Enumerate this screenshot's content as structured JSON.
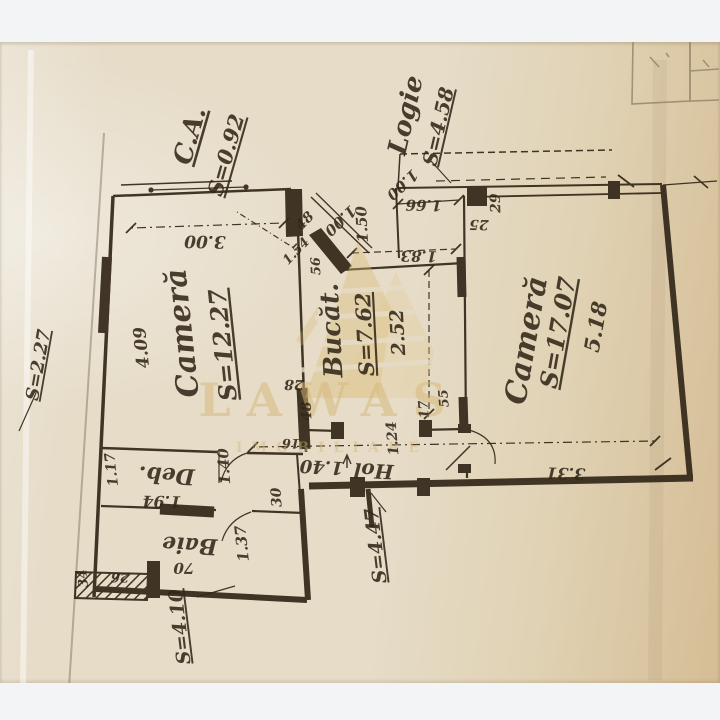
{
  "colors": {
    "ink": "#322718",
    "paper_light": "#ece5d6",
    "paper_mid": "#e6dcc8",
    "paper_dark": "#d5bd95",
    "band": "#f3f4f6",
    "gold": "#d7b878"
  },
  "watermark": {
    "name": "LAWAS",
    "tagline": "IMOBILIARE"
  },
  "labels": [
    {
      "name": "label-ca",
      "t": "C.A.",
      "x": 198,
      "y": 138,
      "r": -74,
      "s": 26,
      "u": 1
    },
    {
      "name": "label-ca-area",
      "t": "S=0.92",
      "x": 233,
      "y": 157,
      "r": -74,
      "s": 21,
      "u": 1
    },
    {
      "name": "label-logie",
      "t": "Logie",
      "x": 414,
      "y": 117,
      "r": -77,
      "s": 26,
      "u": 0
    },
    {
      "name": "label-logie-area",
      "t": "S=4.58",
      "x": 445,
      "y": 128,
      "r": -77,
      "s": 20,
      "u": 1
    },
    {
      "name": "label-camera-left",
      "t": "Cameră",
      "x": 192,
      "y": 332,
      "r": -96,
      "s": 30,
      "u": 0
    },
    {
      "name": "label-camera-left-area",
      "t": "S=12.27",
      "x": 231,
      "y": 344,
      "r": -96,
      "s": 24,
      "u": 1
    },
    {
      "name": "dim-camera-left-width",
      "t": "3.00",
      "x": 205,
      "y": 236,
      "r": 181,
      "s": 17,
      "u": 0
    },
    {
      "name": "dim-camera-left-length",
      "t": "4.09",
      "x": 147,
      "y": 347,
      "r": -96,
      "s": 17,
      "u": 0
    },
    {
      "name": "label-bucatarie",
      "t": "Bucăt.",
      "x": 340,
      "y": 330,
      "r": -93,
      "s": 26,
      "u": 0
    },
    {
      "name": "label-bucatarie-area",
      "t": "S=7.62",
      "x": 372,
      "y": 334,
      "r": -93,
      "s": 21,
      "u": 1
    },
    {
      "name": "dim-bucatarie-width",
      "t": "2.52",
      "x": 404,
      "y": 332,
      "r": -93,
      "s": 19,
      "u": 0
    },
    {
      "name": "label-camera-right",
      "t": "Cameră",
      "x": 536,
      "y": 342,
      "r": -80,
      "s": 30,
      "u": 0
    },
    {
      "name": "label-camera-right-area",
      "t": "S=17.07",
      "x": 566,
      "y": 334,
      "r": -80,
      "s": 24,
      "u": 1
    },
    {
      "name": "dim-camera-right-length",
      "t": "5.18",
      "x": 603,
      "y": 328,
      "r": -80,
      "s": 21,
      "u": 0
    },
    {
      "name": "dim-camera-right-width",
      "t": "3.31",
      "x": 566,
      "y": 468,
      "r": 182,
      "s": 16,
      "u": 0
    },
    {
      "name": "label-hol",
      "t": "Hol",
      "x": 374,
      "y": 464,
      "r": 183,
      "s": 20,
      "u": 0
    },
    {
      "name": "dim-hol-width",
      "t": "1.40",
      "x": 322,
      "y": 461,
      "r": 183,
      "s": 18,
      "u": 0
    },
    {
      "name": "label-hol-area",
      "t": "S=4.47",
      "x": 382,
      "y": 545,
      "r": -97,
      "s": 19,
      "u": 1
    },
    {
      "name": "label-deb",
      "t": "Deb.",
      "x": 167,
      "y": 468,
      "r": 183,
      "s": 22,
      "u": 0
    },
    {
      "name": "dim-deb-width",
      "t": "1.94",
      "x": 162,
      "y": 496,
      "r": 181,
      "s": 16,
      "u": 0
    },
    {
      "name": "dim-deb-depth",
      "t": "1.17",
      "x": 116,
      "y": 469,
      "r": -97,
      "s": 14,
      "u": 0
    },
    {
      "name": "dim-deb-door",
      "t": "1.40",
      "x": 229,
      "y": 466,
      "r": -94,
      "s": 15,
      "u": 0
    },
    {
      "name": "label-baie",
      "t": "Baie",
      "x": 190,
      "y": 538,
      "r": 183,
      "s": 22,
      "u": 0
    },
    {
      "name": "dim-baie-width",
      "t": "70",
      "x": 184,
      "y": 563,
      "r": 181,
      "s": 15,
      "u": 0
    },
    {
      "name": "dim-baie-length",
      "t": "1.37",
      "x": 247,
      "y": 543,
      "r": -96,
      "s": 15,
      "u": 0
    },
    {
      "name": "dim-baie-wall",
      "t": "30",
      "x": 281,
      "y": 497,
      "r": -94,
      "s": 14,
      "u": 0
    },
    {
      "name": "label-area-bottom-left",
      "t": "S=4.10",
      "x": 186,
      "y": 626,
      "r": -97,
      "s": 19,
      "u": 1
    },
    {
      "name": "label-area-left",
      "t": "S=2.27",
      "x": 44,
      "y": 366,
      "r": -80,
      "s": 18,
      "u": 1
    },
    {
      "name": "dim-entry-diag-left",
      "t": "1.00",
      "x": 337,
      "y": 217,
      "r": 137,
      "s": 15,
      "u": 0
    },
    {
      "name": "dim-entry-diag-right",
      "t": "1.00",
      "x": 399,
      "y": 181,
      "r": 137,
      "s": 15,
      "u": 0
    },
    {
      "name": "dim-entry-wall",
      "t": "1.50",
      "x": 367,
      "y": 224,
      "r": -93,
      "s": 15,
      "u": 0
    },
    {
      "name": "dim-logie-window",
      "t": "1.66",
      "x": 424,
      "y": 200,
      "r": 181,
      "s": 15,
      "u": 0
    },
    {
      "name": "dim-logie-pillar",
      "t": "25",
      "x": 479,
      "y": 220,
      "r": 181,
      "s": 14,
      "u": 0
    },
    {
      "name": "dim-logie-end",
      "t": "29",
      "x": 500,
      "y": 203,
      "r": -92,
      "s": 14,
      "u": 0
    },
    {
      "name": "dim-bucatarie-top",
      "t": "1.83",
      "x": 419,
      "y": 251,
      "r": 181,
      "s": 15,
      "u": 0
    },
    {
      "name": "dim-entry-48",
      "t": "48",
      "x": 308,
      "y": 224,
      "r": -46,
      "s": 14,
      "u": 0
    },
    {
      "name": "dim-entry-154",
      "t": "1.54",
      "x": 299,
      "y": 254,
      "r": -46,
      "s": 13,
      "u": 0
    },
    {
      "name": "dim-entry-56",
      "t": "56",
      "x": 320,
      "y": 266,
      "r": -92,
      "s": 13,
      "u": 0
    },
    {
      "name": "dim-wall-28",
      "t": "28",
      "x": 294,
      "y": 380,
      "r": 181,
      "s": 14,
      "u": 0
    },
    {
      "name": "dim-wall-48",
      "t": "48",
      "x": 311,
      "y": 411,
      "r": -93,
      "s": 14,
      "u": 0
    },
    {
      "name": "dim-wall-16",
      "t": "16",
      "x": 291,
      "y": 439,
      "r": 181,
      "s": 13,
      "u": 0
    },
    {
      "name": "dim-bucatarie-door",
      "t": "1.24",
      "x": 397,
      "y": 438,
      "r": -95,
      "s": 14,
      "u": 0
    },
    {
      "name": "dim-wall-17",
      "t": "17",
      "x": 428,
      "y": 409,
      "r": -95,
      "s": 13,
      "u": 0
    },
    {
      "name": "dim-wall-55",
      "t": "55",
      "x": 448,
      "y": 398,
      "r": -95,
      "s": 13,
      "u": 0
    },
    {
      "name": "dim-wall-26",
      "t": "26",
      "x": 120,
      "y": 573,
      "r": 181,
      "s": 13,
      "u": 0
    },
    {
      "name": "dim-wall-34",
      "t": "34",
      "x": 87,
      "y": 578,
      "r": -96,
      "s": 13,
      "u": 0
    }
  ]
}
